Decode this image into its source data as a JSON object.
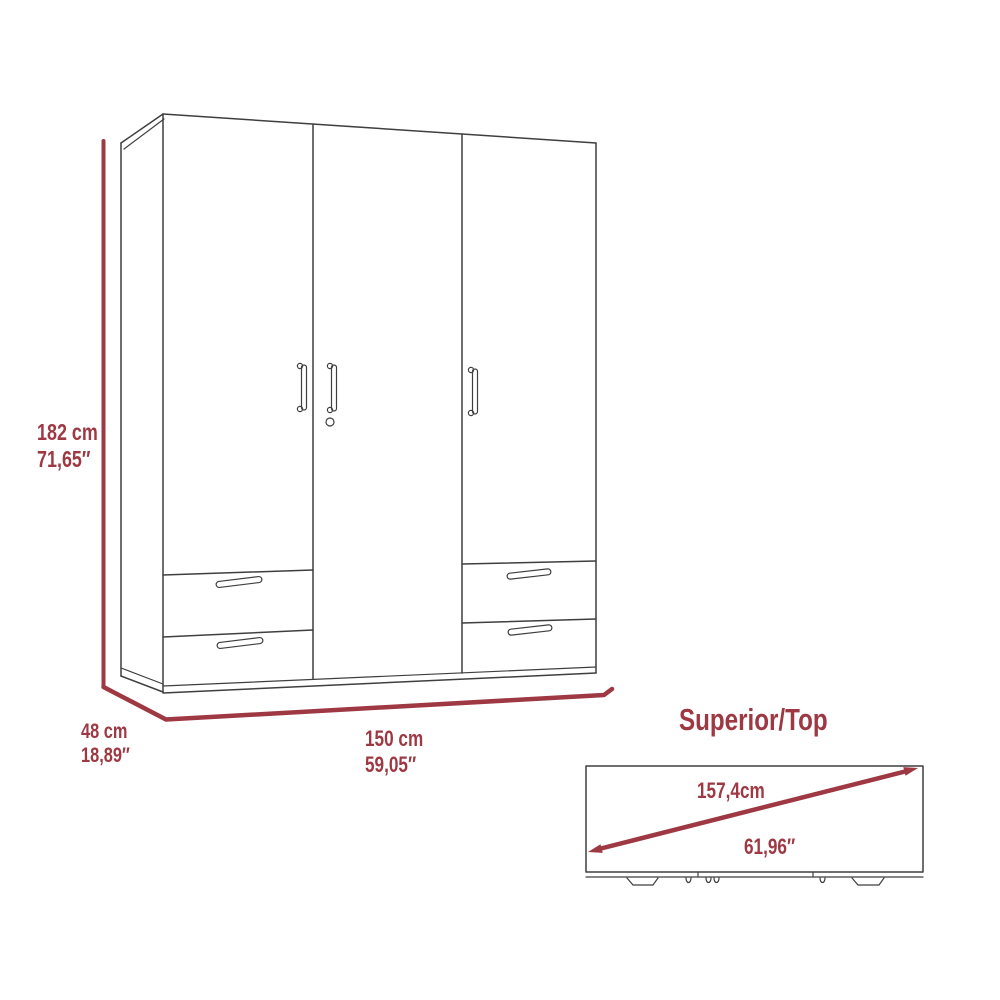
{
  "colors": {
    "accent": "#9e3944",
    "line": "#3f3f3f",
    "background": "#ffffff"
  },
  "front_view": {
    "height": {
      "cm": "182 cm",
      "inches": "71,65″"
    },
    "depth": {
      "cm": "48 cm",
      "inches": "18,89″"
    },
    "width": {
      "cm": "150 cm",
      "inches": "59,05″"
    }
  },
  "top_view": {
    "title": "Superior/Top",
    "diagonal": {
      "cm": "157,4cm",
      "inches": "61,96″"
    }
  }
}
